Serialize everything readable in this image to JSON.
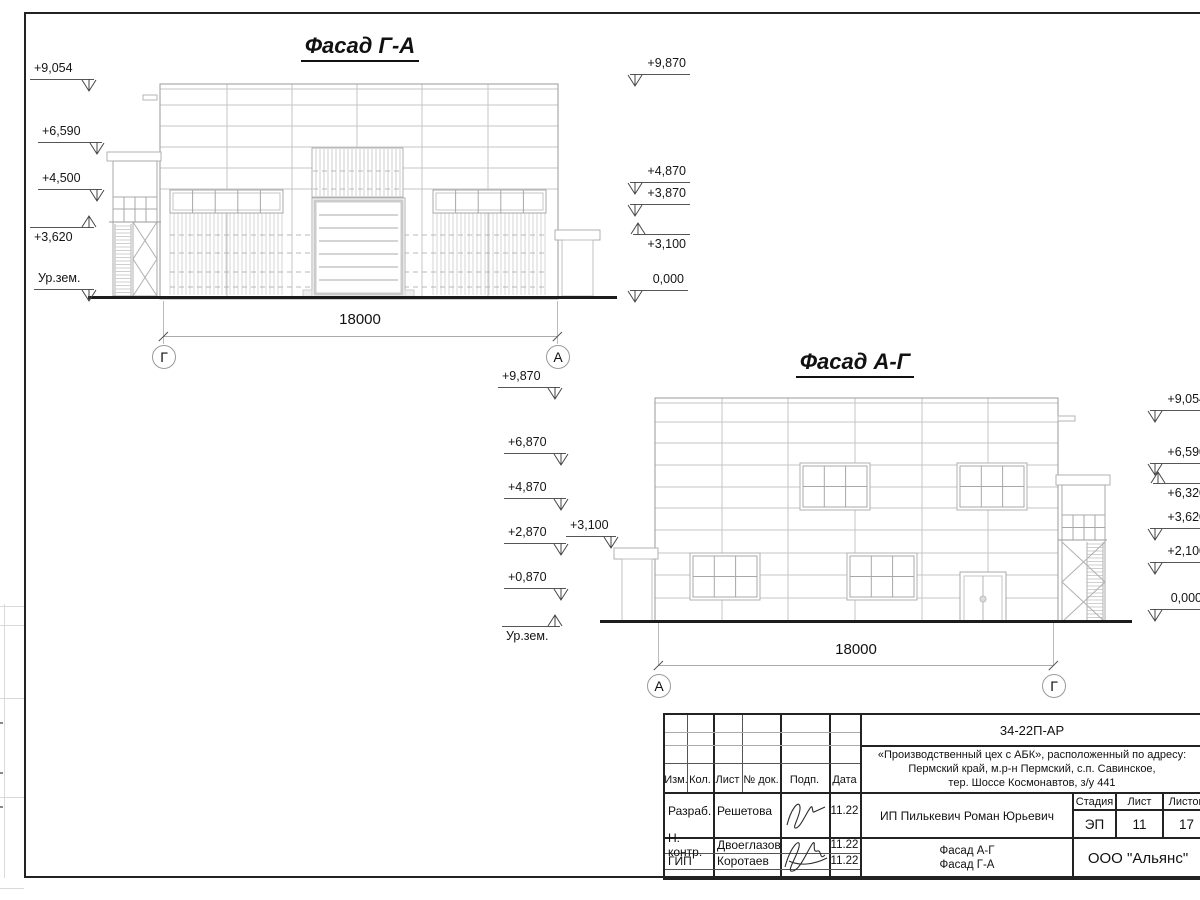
{
  "drawing": {
    "facade1": {
      "title": "Фасад Г-А",
      "dimension": "18000",
      "axis_left": "Г",
      "axis_right": "А",
      "left_marks": [
        "+9,054",
        "+6,590",
        "+4,500",
        "+3,620",
        "Ур.зем."
      ],
      "right_marks": [
        "+9,870",
        "+4,870",
        "+3,870",
        "+3,100",
        "0,000"
      ]
    },
    "facade2": {
      "title": "Фасад А-Г",
      "dimension": "18000",
      "axis_left": "А",
      "axis_right": "Г",
      "left_marks": [
        "+9,870",
        "+6,870",
        "+4,870",
        "+2,870",
        "+0,870",
        "Ур.зем."
      ],
      "canopy_mark": "+3,100",
      "right_marks": [
        "+9,054",
        "+6,590",
        "+6,320",
        "+3,620",
        "+2,100",
        "0,000"
      ]
    }
  },
  "titleblock": {
    "doc_number": "34-22П-АР",
    "project": [
      "«Производственный цех с АБК», расположенный по адресу:",
      "Пермский край, м.р-н Пермский, с.п. Савинское,",
      "тер. Шоссе Космонавтов, з/у 441"
    ],
    "columns": [
      "Изм.",
      "Кол.",
      "Лист",
      "№ док.",
      "Подп.",
      "Дата"
    ],
    "rows": [
      {
        "role": "Разраб.",
        "name": "Решетова",
        "date": "11.22"
      },
      {
        "role": "Н. контр.",
        "name": "Двоеглазов",
        "date": "11.22"
      },
      {
        "role": "ГИП",
        "name": "Коротаев",
        "date": "11.22"
      }
    ],
    "client": "ИП Пилькевич Роман Юрьевич",
    "stage_label": "Стадия",
    "sheet_label": "Лист",
    "sheets_label": "Листов",
    "stage": "ЭП",
    "sheet": "11",
    "sheets": "17",
    "sheet_titles": [
      "Фасад А-Г",
      "Фасад Г-А"
    ],
    "company": "ООО \"Альянс\""
  }
}
